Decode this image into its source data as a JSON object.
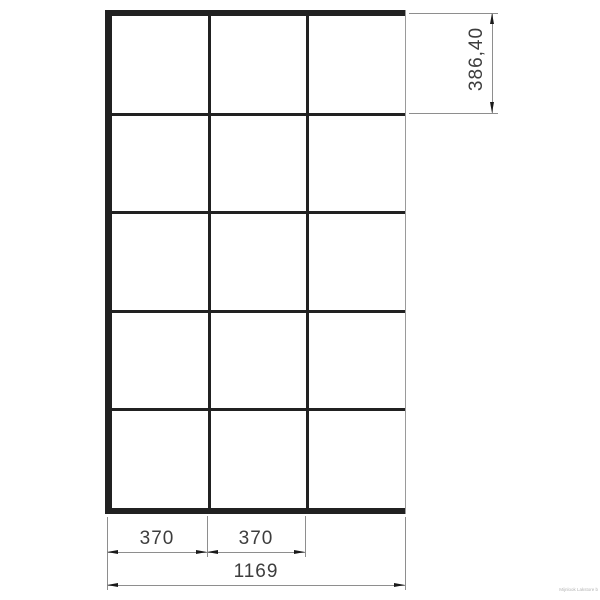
{
  "drawing": {
    "type": "technical-dimension-drawing",
    "grid": {
      "rows": 5,
      "columns": 3
    },
    "dims": {
      "row_height": "386,40",
      "column_1_width": "370",
      "column_2_width": "370",
      "total_width": "1169"
    },
    "colors": {
      "frame_line": "#212121",
      "right_edge_line": "#9a9a9a",
      "dim_line": "#8e8e8e",
      "arrow": "#1a1a1a",
      "dim_text": "#3d3d3d",
      "background": "#ffffff"
    },
    "watermark": "Mijnlook Lakstore b"
  }
}
